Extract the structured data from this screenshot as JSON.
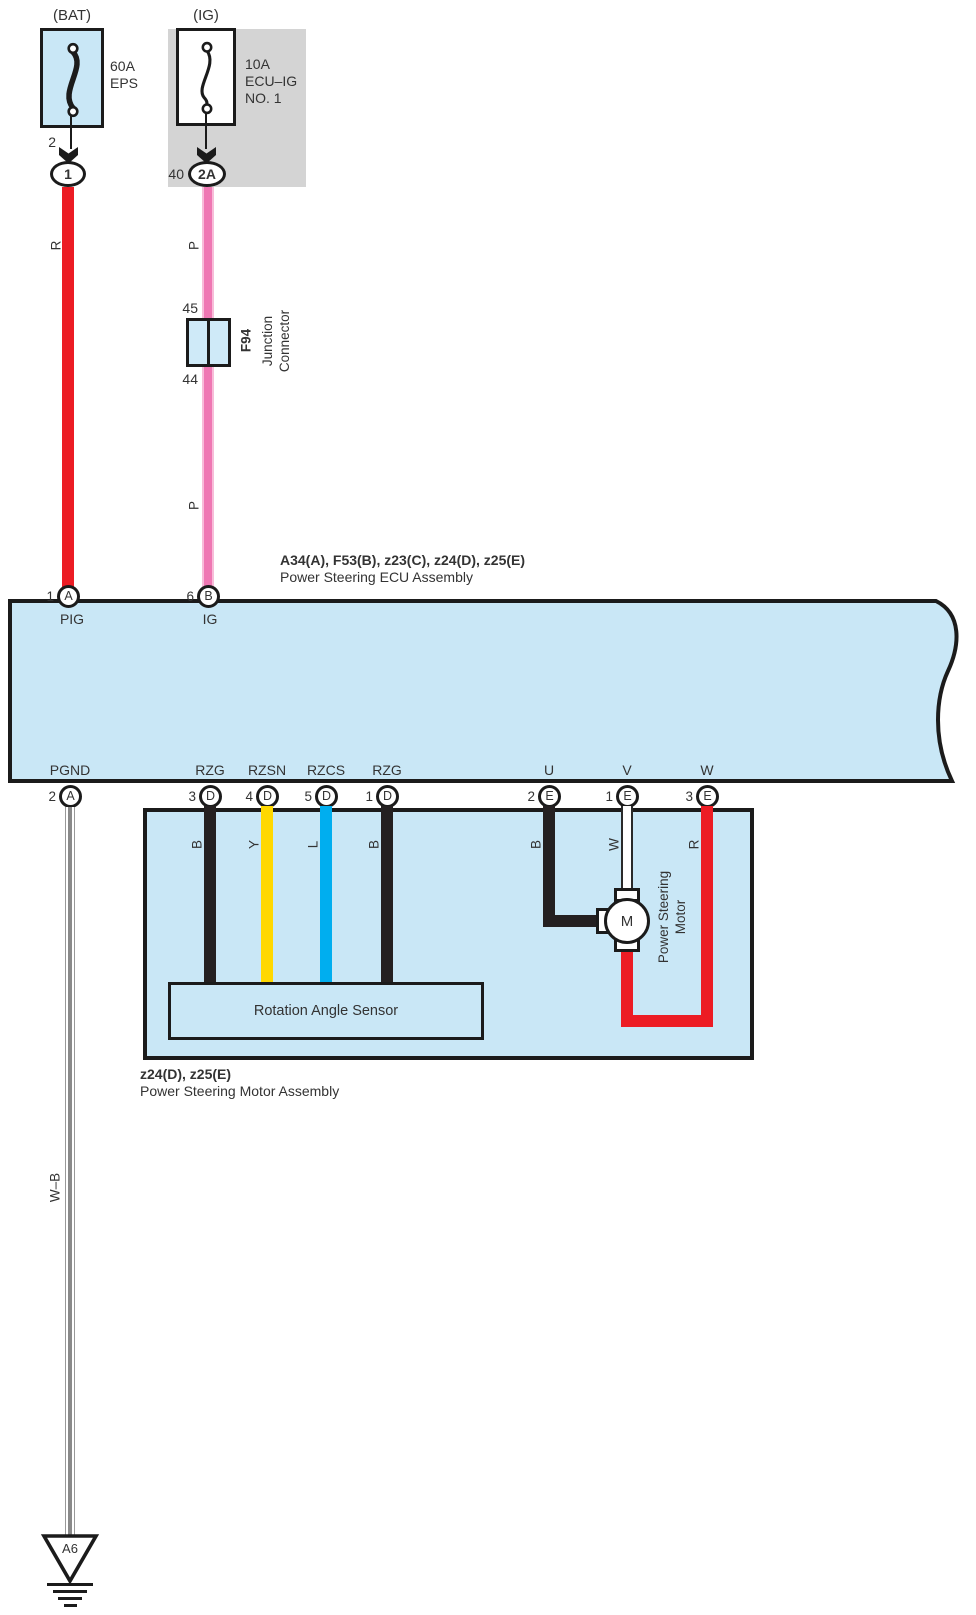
{
  "colors": {
    "component_fill_blue": "#c9e7f6",
    "shield_gray": "#d4d4d4",
    "wire_red": "#ec1c24",
    "wire_pink": "#ef77b3",
    "wire_yellow": "#ffd800",
    "wire_blue": "#00aeef",
    "wire_black": "#242021",
    "line_black": "#1b1b1b"
  },
  "bat_circuit": {
    "source_label": "(BAT)",
    "fuse_rating": "60A",
    "fuse_name": "EPS",
    "fuse_output_pin": "2",
    "connector_id": "1",
    "wire_color": "R"
  },
  "ig_circuit": {
    "source_label": "(IG)",
    "fuse_rating": "10A",
    "fuse_name_line1": "ECU–IG",
    "fuse_name_line2": "NO. 1",
    "connector_pin": "40",
    "connector_id": "2A",
    "wire_color_upper": "P",
    "wire_color_lower": "P"
  },
  "junction_connector": {
    "pin_in": "45",
    "pin_out": "44",
    "code": "F94",
    "name_line1": "Junction",
    "name_line2": "Connector"
  },
  "ecu": {
    "connector_codes": "A34(A), F53(B), z23(C), z24(D), z25(E)",
    "name": "Power Steering ECU Assembly",
    "top_pins": [
      {
        "pin": "1",
        "connector": "A",
        "signal": "PIG"
      },
      {
        "pin": "6",
        "connector": "B",
        "signal": "IG"
      }
    ],
    "bottom_pins": [
      {
        "pin": "2",
        "connector": "A",
        "signal": "PGND"
      },
      {
        "pin": "3",
        "connector": "D",
        "signal": "RZG"
      },
      {
        "pin": "4",
        "connector": "D",
        "signal": "RZSN"
      },
      {
        "pin": "5",
        "connector": "D",
        "signal": "RZCS"
      },
      {
        "pin": "1",
        "connector": "D",
        "signal": "RZG"
      },
      {
        "pin": "2",
        "connector": "E",
        "signal": "U"
      },
      {
        "pin": "1",
        "connector": "E",
        "signal": "V"
      },
      {
        "pin": "3",
        "connector": "E",
        "signal": "W"
      }
    ]
  },
  "motor_assembly": {
    "connector_codes": "z24(D), z25(E)",
    "name": "Power Steering Motor Assembly",
    "rotation_angle_sensor_label": "Rotation Angle Sensor",
    "motor_label_line1": "Power Steering",
    "motor_label_line2": "Motor",
    "motor_symbol": "M",
    "wire_colors": [
      "B",
      "Y",
      "L",
      "B",
      "B",
      "W",
      "R"
    ]
  },
  "ground": {
    "wire_color": "W–B",
    "ground_point": "A6"
  }
}
